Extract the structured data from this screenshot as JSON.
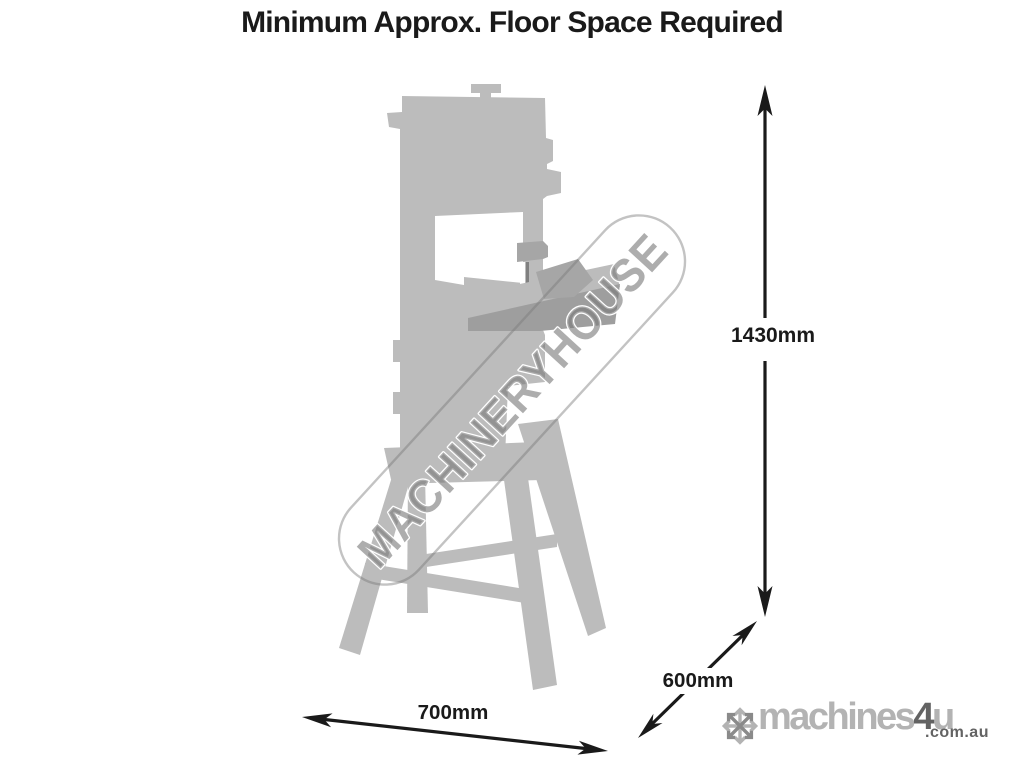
{
  "title": "Minimum Approx. Floor Space Required",
  "watermark": {
    "text": "MACHINERYHOUSE"
  },
  "machine": {
    "name": "bandsaw-on-stand-silhouette"
  },
  "dimensions": {
    "height_label": "1430mm",
    "width_label": "700mm",
    "depth_label": "600mm"
  },
  "logo": {
    "brand": "machines",
    "accent": "4",
    "suffix": "u",
    "domain": ".com.au",
    "icon": "snowflake-asterisk-icon"
  },
  "colors": {
    "machine_gray": "#bcbcbc",
    "machine_mid": "#a6a6a6",
    "machine_dark": "#9e9e9e",
    "blade_gray": "#808080",
    "watermark_gray": "#7a7a7a",
    "ink": "#1a1a1a",
    "logo_light": "#b3b3b3",
    "logo_mid": "#8a8a8a",
    "logo_dark": "#636363"
  }
}
